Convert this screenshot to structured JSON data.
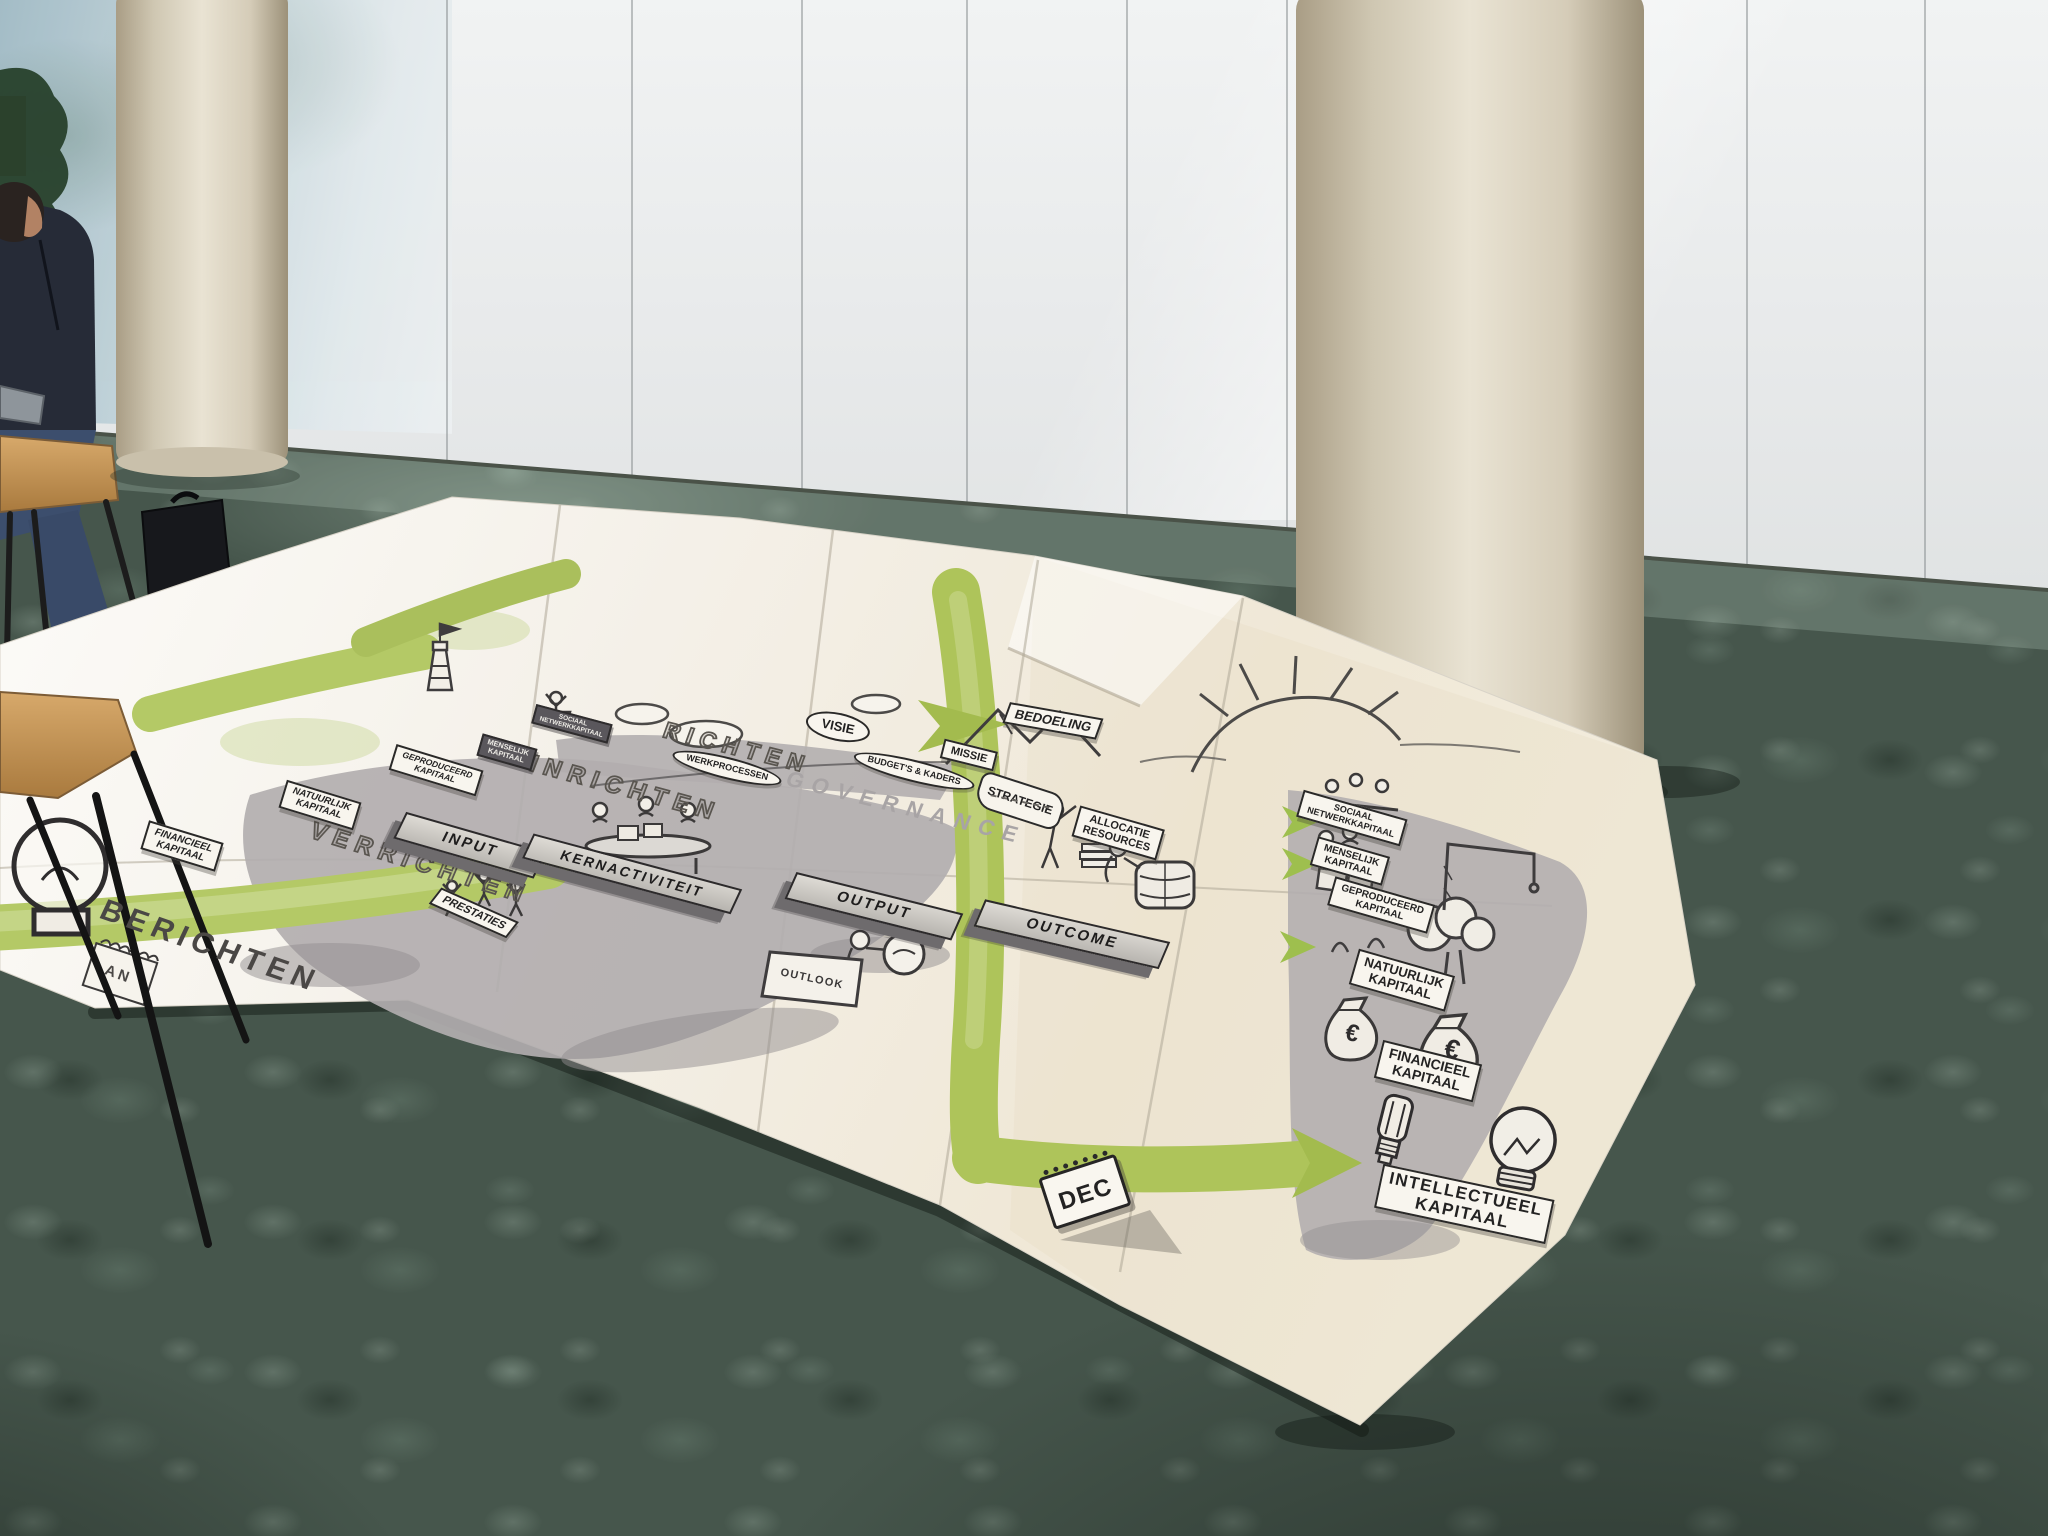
{
  "scene": {
    "setting": "Large hand-drawn Dutch strategy poster spread on green mottled office carpet in front of a white glass wall with two beige round pillars; a seated man and black bags at the far left; wooden stool in the foreground."
  },
  "poster": {
    "phases": {
      "richten": "RICHTEN",
      "inrichten": "INRICHTEN",
      "verrichten": "VERRICHTEN",
      "berichten": "BERICHTEN"
    },
    "governance_label": "GOVERNANCE",
    "flow_bars": {
      "input": "INPUT",
      "kernactiviteit": "KERNACTIVITEIT",
      "output": "OUTPUT",
      "outcome": "OUTCOME"
    },
    "direction": {
      "bedoeling": "BEDOELING",
      "visie": "VISIE",
      "missie": "MISSIE",
      "strategie": "STRATEGIE",
      "werkprocessen": "WERKPROCESSEN",
      "budgetten_kaders": "BUDGET'S & KADERS",
      "allocatie_line1": "ALLOCATIE",
      "allocatie_line2": "RESOURCES"
    },
    "results": {
      "prestaties": "PRESTATIES",
      "outlook": "OUTLOOK",
      "dec_calendar": "DEC",
      "notepad_fragment": "AN",
      "euro_symbol": "€"
    },
    "capitals_right": [
      {
        "id": "sociaal",
        "line1": "SOCIAAL",
        "line2": "NETWERKKAPITAAL"
      },
      {
        "id": "menselijk",
        "line1": "MENSELIJK",
        "line2": "KAPITAAL"
      },
      {
        "id": "geproduceerd",
        "line1": "GEPRODUCEERD",
        "line2": "KAPITAAL"
      },
      {
        "id": "natuurlijk",
        "line1": "NATUURLIJK",
        "line2": "KAPITAAL"
      },
      {
        "id": "financieel",
        "line1": "FINANCIEEL",
        "line2": "KAPITAAL"
      },
      {
        "id": "intellectueel",
        "line1": "INTELLECTUEEL",
        "line2": "KAPITAAL"
      }
    ],
    "capitals_left": [
      {
        "id": "sociaal-left",
        "line1": "SOCIAAL",
        "line2": "NETWERKKAPITAAL"
      },
      {
        "id": "menselijk-left",
        "line1": "MENSELIJK",
        "line2": "KAPITAAL"
      },
      {
        "id": "geproduceerd-left",
        "line1": "GEPRODUCEERD",
        "line2": "KAPITAAL"
      },
      {
        "id": "natuurlijk-left",
        "line1": "NATUURLIJK",
        "line2": "KAPITAAL"
      },
      {
        "id": "financieel-left",
        "line1": "FINANCIEEL",
        "line2": "KAPITAAL"
      }
    ]
  },
  "colors": {
    "poster_paper": "#f3efe6",
    "diagram_grey": "#b2aeaf",
    "flow_bar_grey": "#6f6c6e",
    "accent_green": "#aec457",
    "carpet_green": "#46564c",
    "pillar_beige": "#d6cdb9",
    "wall_white": "#e9ebeb"
  }
}
